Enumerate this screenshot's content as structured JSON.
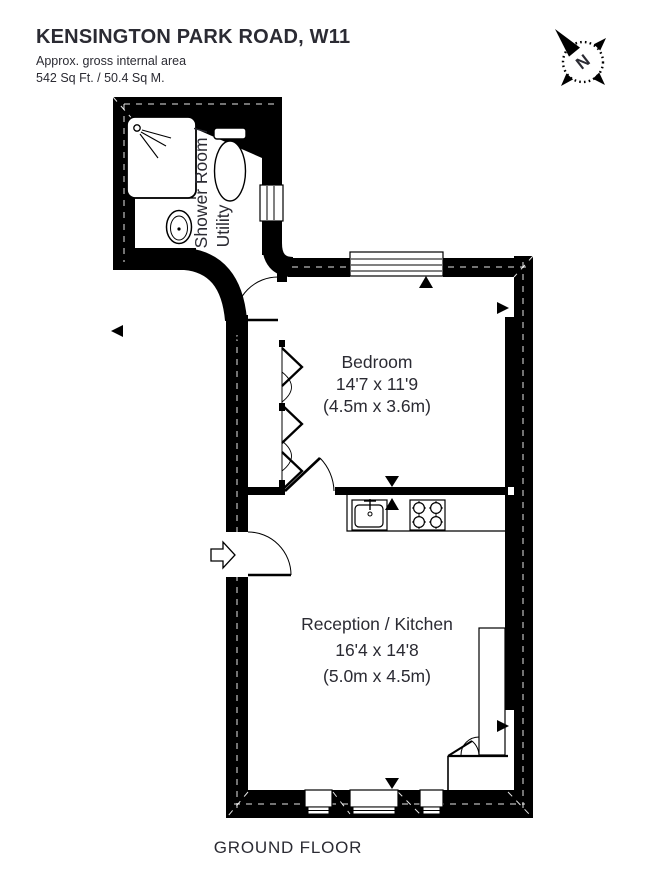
{
  "header": {
    "title": "KENSINGTON PARK ROAD, W11",
    "subtitle_line1": "Approx. gross internal area",
    "subtitle_line2": "542 Sq Ft. / 50.4 Sq M."
  },
  "compass": {
    "letter": "N"
  },
  "plan": {
    "shower_room": {
      "label_line1": "Shower Room /",
      "label_line2": "Utility"
    },
    "bedroom": {
      "label": "Bedroom",
      "imperial": "14'7 x 11'9",
      "metric": "(4.5m x 3.6m)"
    },
    "reception": {
      "label": "Reception / Kitchen",
      "imperial": "16'4 x 14'8",
      "metric": "(5.0m x 4.5m)"
    }
  },
  "footer": {
    "label": "GROUND FLOOR"
  },
  "colors": {
    "wall": "#000000",
    "text": "#2b2b33",
    "background": "#ffffff"
  }
}
